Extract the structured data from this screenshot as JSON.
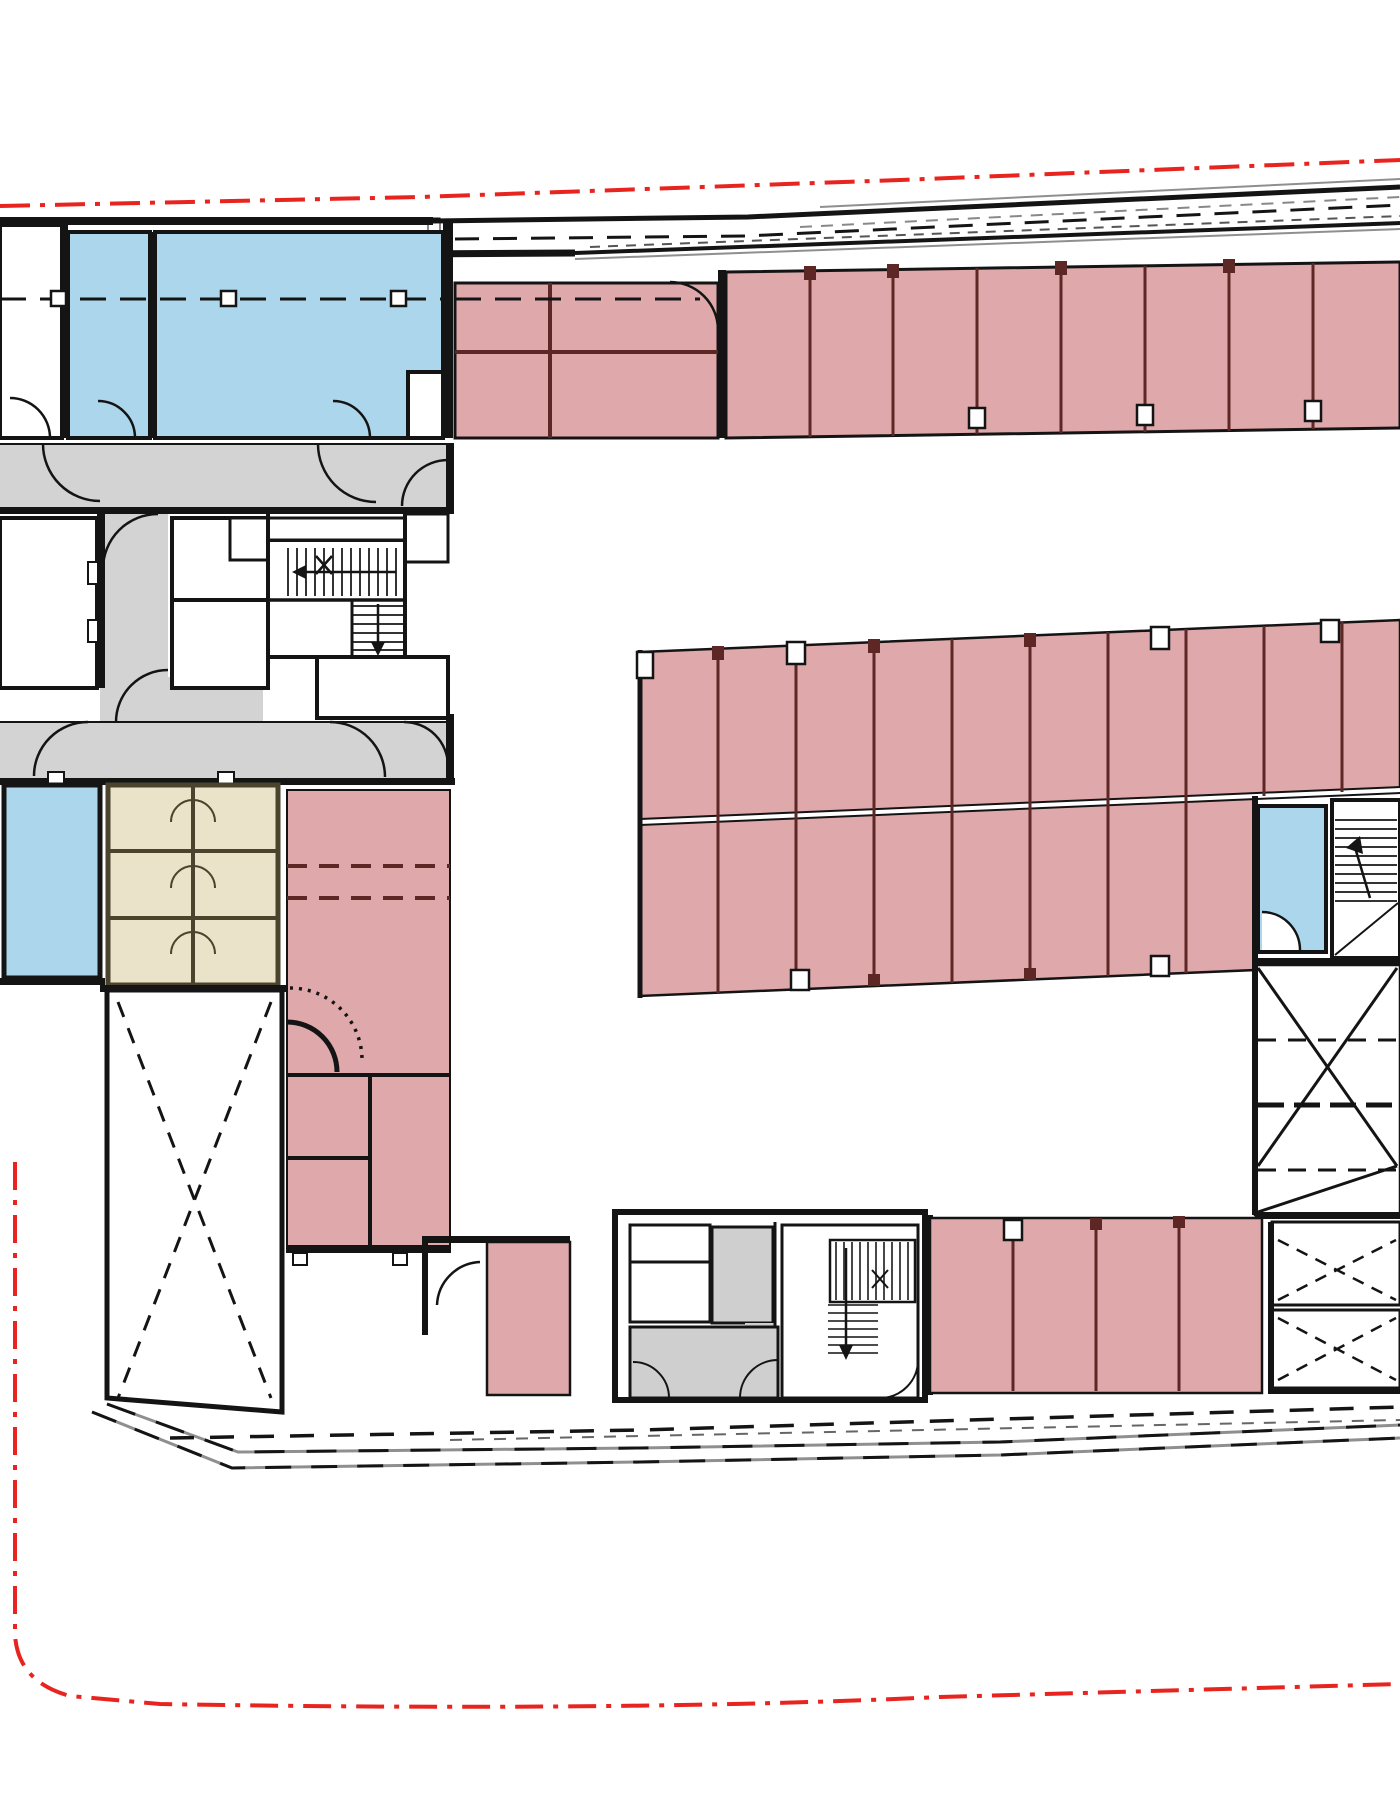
{
  "drawing": {
    "kind": "architectural-floor-plan",
    "level": "parking-level",
    "visible_text": []
  },
  "colors": {
    "paper": "#ffffff",
    "wall": "#141414",
    "line_gray": "#8f8f8f",
    "parking_fill": "#dfa8ab",
    "parking_divider": "#5d2726",
    "room_blue": "#abd6eb",
    "wc_beige": "#eae3c9",
    "wc_wall": "#4a442e",
    "circulation_gray": "#d3d3d3",
    "shaft_gray": "#cfcfcf",
    "boundary_red": "#e8241f",
    "tread": "#333333"
  },
  "legend": {
    "pink_zones": "parking stalls",
    "blue_zones": "technical / storage rooms",
    "beige_zone": "wc cabins",
    "gray_zones": "circulation corridors",
    "red_line": "site boundary (dash-dot)"
  }
}
